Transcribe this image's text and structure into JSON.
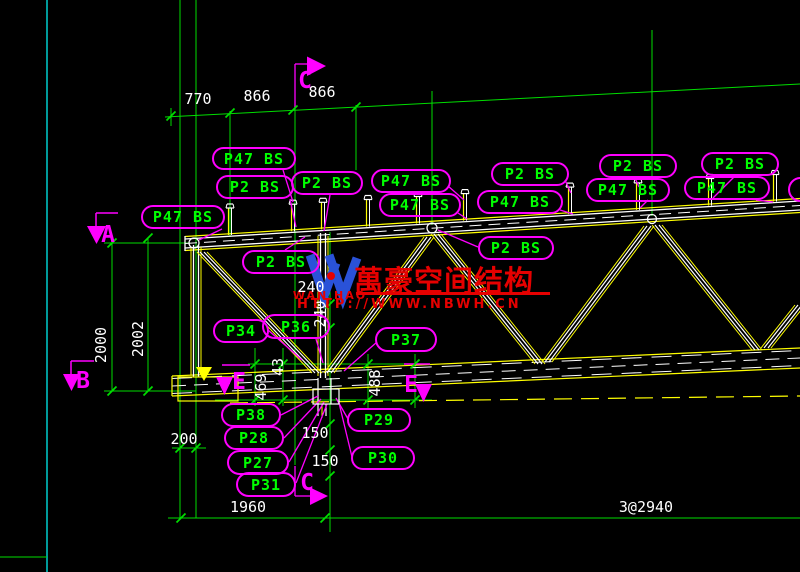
{
  "canvas": {
    "width": 800,
    "height": 572
  },
  "colors": {
    "background": "#000000",
    "grid_green": "#00dd00",
    "cyan": "#00dddd",
    "magenta": "#ff00ff",
    "white": "#ffffff",
    "yellow": "#ffff00",
    "label_green": "#00ff00",
    "watermark_red": "#e60000",
    "logo_blue": "#2a52d8"
  },
  "dims": {
    "top": [
      "770",
      "866",
      "866"
    ],
    "left": [
      "2000",
      "2002"
    ],
    "mid_240_h": "240",
    "mid_240_v": "240",
    "d43": "43",
    "d469": "469",
    "d488": "488",
    "d200": "200",
    "d150_a": "150",
    "d150_b": "150",
    "d1960": "1960",
    "span": "3@2940"
  },
  "markers": {
    "a": "A",
    "b": "B",
    "c_top": "C",
    "c_bottom": "C",
    "e_left": "E",
    "e_right": "E"
  },
  "watermark": {
    "title": "萬豪空间结构",
    "url": "HTTP://WWW.NBWH.CN",
    "logo_caption": "WAN HAO"
  },
  "part_labels": [
    {
      "text": "P47 BS",
      "x": 212,
      "y": 147,
      "w": 84,
      "h": 23
    },
    {
      "text": "P2 BS",
      "x": 216,
      "y": 175,
      "w": 78,
      "h": 24
    },
    {
      "text": "P2 BS",
      "x": 291,
      "y": 171,
      "w": 72,
      "h": 24
    },
    {
      "text": "P47 BS",
      "x": 141,
      "y": 205,
      "w": 84,
      "h": 24
    },
    {
      "text": "P2 BS",
      "x": 242,
      "y": 250,
      "w": 78,
      "h": 24
    },
    {
      "text": "P47 BS",
      "x": 371,
      "y": 169,
      "w": 80,
      "h": 24
    },
    {
      "text": "P47 BS",
      "x": 379,
      "y": 193,
      "w": 82,
      "h": 24
    },
    {
      "text": "P2 BS",
      "x": 491,
      "y": 162,
      "w": 78,
      "h": 24
    },
    {
      "text": "P47 BS",
      "x": 477,
      "y": 190,
      "w": 86,
      "h": 24
    },
    {
      "text": "P2 BS",
      "x": 478,
      "y": 236,
      "w": 76,
      "h": 24
    },
    {
      "text": "P2 BS",
      "x": 599,
      "y": 154,
      "w": 78,
      "h": 24
    },
    {
      "text": "P47 BS",
      "x": 586,
      "y": 178,
      "w": 84,
      "h": 24
    },
    {
      "text": "P2 BS",
      "x": 701,
      "y": 152,
      "w": 78,
      "h": 24
    },
    {
      "text": "P47 BS",
      "x": 684,
      "y": 176,
      "w": 86,
      "h": 24
    },
    {
      "text": "P34",
      "x": 213,
      "y": 319,
      "w": 56,
      "h": 24
    },
    {
      "text": "P36",
      "x": 262,
      "y": 314,
      "w": 68,
      "h": 25
    },
    {
      "text": "P37",
      "x": 375,
      "y": 327,
      "w": 62,
      "h": 25
    },
    {
      "text": "P38",
      "x": 221,
      "y": 403,
      "w": 60,
      "h": 24
    },
    {
      "text": "P28",
      "x": 224,
      "y": 426,
      "w": 60,
      "h": 24
    },
    {
      "text": "P27",
      "x": 227,
      "y": 450,
      "w": 62,
      "h": 25
    },
    {
      "text": "P31",
      "x": 236,
      "y": 472,
      "w": 60,
      "h": 25
    },
    {
      "text": "P29",
      "x": 347,
      "y": 408,
      "w": 64,
      "h": 24
    },
    {
      "text": "P30",
      "x": 351,
      "y": 446,
      "w": 64,
      "h": 24
    },
    {
      "text": "",
      "x": 788,
      "y": 177,
      "w": 46,
      "h": 25
    }
  ]
}
